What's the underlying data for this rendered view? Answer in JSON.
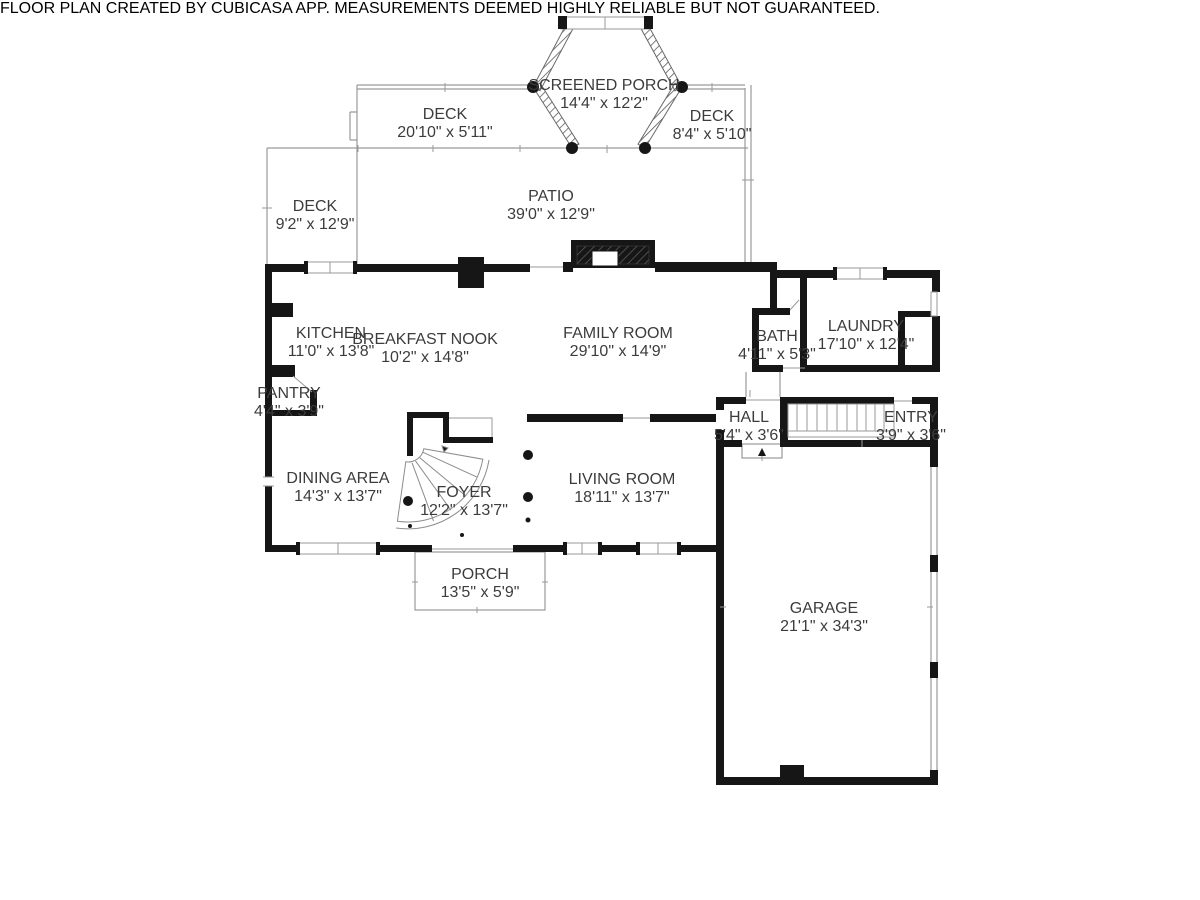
{
  "title": "First floor plan",
  "footer": {
    "text": "FLOOR PLAN CREATED BY CUBICASA APP. MEASUREMENTS DEEMED HIGHLY RELIABLE BUT NOT GUARANTEED."
  },
  "colors": {
    "wall": "#161616",
    "thin_line": "#9a9a9a",
    "screen_hatch": "#5a5a5a",
    "label_text": "#3c3c3c",
    "footer_text": "#cccccc",
    "background": "#ffffff"
  },
  "rooms": [
    {
      "id": "screened-porch",
      "name": "SCREENED PORCH",
      "dims": "14'4\" x 12'2\""
    },
    {
      "id": "deck-top",
      "name": "DECK",
      "dims": "20'10\" x 5'11\""
    },
    {
      "id": "deck-right",
      "name": "DECK",
      "dims": "8'4\" x 5'10\""
    },
    {
      "id": "deck-left",
      "name": "DECK",
      "dims": "9'2\" x 12'9\""
    },
    {
      "id": "patio",
      "name": "PATIO",
      "dims": "39'0\" x 12'9\""
    },
    {
      "id": "kitchen",
      "name": "KITCHEN",
      "dims": "11'0\" x 13'8\""
    },
    {
      "id": "breakfast-nook",
      "name": "BREAKFAST NOOK",
      "dims": "10'2\" x 14'8\""
    },
    {
      "id": "family-room",
      "name": "FAMILY ROOM",
      "dims": "29'10\" x 14'9\""
    },
    {
      "id": "bath",
      "name": "BATH",
      "dims": "4'11\" x 5'3\""
    },
    {
      "id": "laundry",
      "name": "LAUNDRY",
      "dims": "17'10\" x 12'4\""
    },
    {
      "id": "pantry",
      "name": "PANTRY",
      "dims": "4'4\" x 3'9\""
    },
    {
      "id": "hall",
      "name": "HALL",
      "dims": "5'4\" x 3'6\""
    },
    {
      "id": "entry",
      "name": "ENTRY",
      "dims": "3'9\" x 3'6\""
    },
    {
      "id": "dining-area",
      "name": "DINING AREA",
      "dims": "14'3\" x 13'7\""
    },
    {
      "id": "foyer",
      "name": "FOYER",
      "dims": "12'2\" x 13'7\""
    },
    {
      "id": "living-room",
      "name": "LIVING ROOM",
      "dims": "18'11\" x 13'7\""
    },
    {
      "id": "porch",
      "name": "PORCH",
      "dims": "13'5\" x 5'9\""
    },
    {
      "id": "garage",
      "name": "GARAGE",
      "dims": "21'1\" x 34'3\""
    }
  ]
}
